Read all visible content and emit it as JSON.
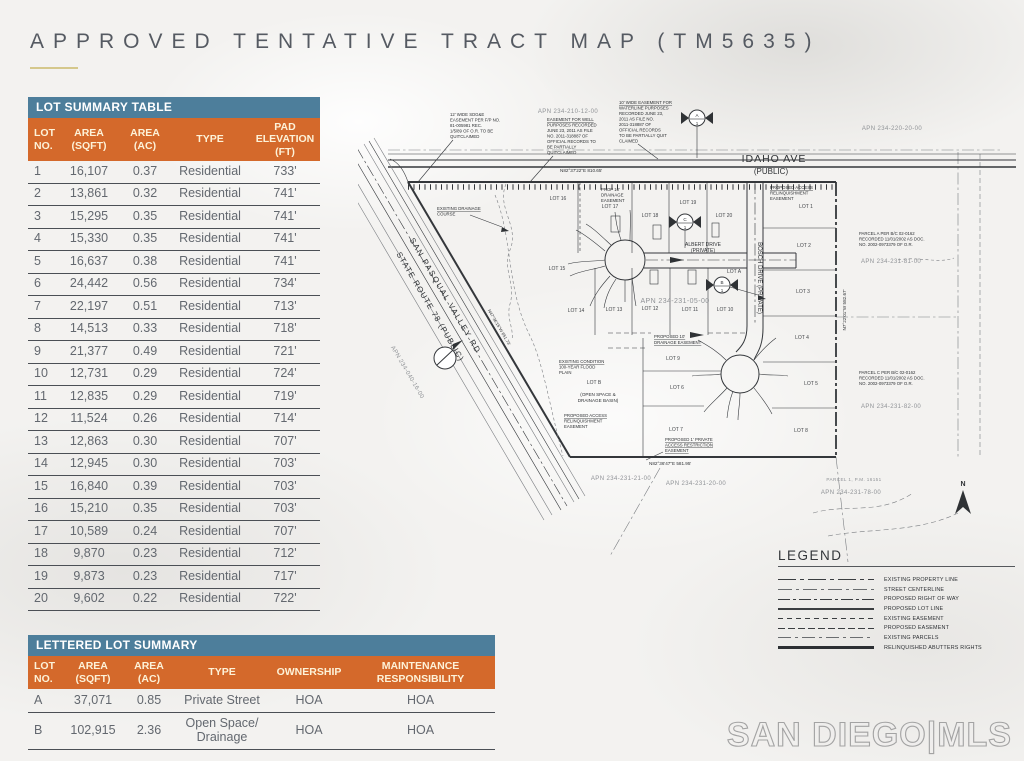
{
  "page_title": "APPROVED TENTATIVE TRACT MAP (TM5635)",
  "lot_summary": {
    "title": "LOT SUMMARY TABLE",
    "columns": [
      "LOT NO.",
      "AREA (SQFT)",
      "AREA (AC)",
      "TYPE",
      "PAD ELEVATION (FT)"
    ],
    "rows": [
      [
        "1",
        "16,107",
        "0.37",
        "Residential",
        "733'"
      ],
      [
        "2",
        "13,861",
        "0.32",
        "Residential",
        "741'"
      ],
      [
        "3",
        "15,295",
        "0.35",
        "Residential",
        "741'"
      ],
      [
        "4",
        "15,330",
        "0.35",
        "Residential",
        "741'"
      ],
      [
        "5",
        "16,637",
        "0.38",
        "Residential",
        "741'"
      ],
      [
        "6",
        "24,442",
        "0.56",
        "Residential",
        "734'"
      ],
      [
        "7",
        "22,197",
        "0.51",
        "Residential",
        "713'"
      ],
      [
        "8",
        "14,513",
        "0.33",
        "Residential",
        "718'"
      ],
      [
        "9",
        "21,377",
        "0.49",
        "Residential",
        "721'"
      ],
      [
        "10",
        "12,731",
        "0.29",
        "Residential",
        "724'"
      ],
      [
        "11",
        "12,835",
        "0.29",
        "Residential",
        "719'"
      ],
      [
        "12",
        "11,524",
        "0.26",
        "Residential",
        "714'"
      ],
      [
        "13",
        "12,863",
        "0.30",
        "Residential",
        "707'"
      ],
      [
        "14",
        "12,945",
        "0.30",
        "Residential",
        "703'"
      ],
      [
        "15",
        "16,840",
        "0.39",
        "Residential",
        "703'"
      ],
      [
        "16",
        "15,210",
        "0.35",
        "Residential",
        "703'"
      ],
      [
        "17",
        "10,589",
        "0.24",
        "Residential",
        "707'"
      ],
      [
        "18",
        "9,870",
        "0.23",
        "Residential",
        "712'"
      ],
      [
        "19",
        "9,873",
        "0.23",
        "Residential",
        "717'"
      ],
      [
        "20",
        "9,602",
        "0.22",
        "Residential",
        "722'"
      ]
    ]
  },
  "lettered_summary": {
    "title": "LETTERED LOT SUMMARY",
    "columns": [
      "LOT NO.",
      "AREA (SQFT)",
      "AREA (AC)",
      "TYPE",
      "OWNERSHIP",
      "MAINTENANCE RESPONSIBILITY"
    ],
    "rows": [
      [
        "A",
        "37,071",
        "0.85",
        "Private Street",
        "HOA",
        "HOA"
      ],
      [
        "B",
        "102,915",
        "2.36",
        "Open Space/ Drainage",
        "HOA",
        "HOA"
      ]
    ]
  },
  "map": {
    "streets": {
      "idaho": [
        "IDAHO AVE",
        "(PUBLIC)"
      ],
      "san_pasqual": [
        "SAN PASQUAL VALLEY RD",
        "STATE ROUTE 78 (PUBLIC)"
      ],
      "albert": [
        "ALBERT DRIVE",
        "(PRIVATE)"
      ],
      "bosch": "BOSCH DRIVE (PRIVATE)"
    },
    "bearings": {
      "top": "N82°37'22\"E   810.65'",
      "bottom": "N82°36'47\"E   581.95'",
      "west": "N47°36'15\"W   651.73'",
      "east": "N7°22'01\"W   582.67'"
    },
    "apns": {
      "top_center": "APN 234-210-12-00",
      "top_right": "APN 234-220-20-00",
      "center": "APN 234-231-05-00",
      "parcel_a": "APN 234-231-81-00",
      "parcel_c": "APN 234-231-82-00",
      "bottom_left": "APN 234-231-21-00",
      "bottom_center": "APN 234-231-20-00",
      "bottom_right": "APN 234-231-78-00",
      "west_road": "APN 234-040-16-00"
    },
    "lots": [
      "LOT 1",
      "LOT 2",
      "LOT 3",
      "LOT 4",
      "LOT 5",
      "LOT 6",
      "LOT 7",
      "LOT 8",
      "LOT 9",
      "LOT 10",
      "LOT 11",
      "LOT 12",
      "LOT 13",
      "LOT 14",
      "LOT 15",
      "LOT 16",
      "LOT 17",
      "LOT 18",
      "LOT 19",
      "LOT 20",
      "LOT A",
      "LOT B"
    ],
    "notes": {
      "sdge": [
        "12' WIDE SDG&E",
        "EASEMENT PER F/P NO.",
        "81-005981 REC.",
        "1/5/89 OF O.R. TO BE",
        "QUITCLAIMED"
      ],
      "well": [
        "EASEMENT FOR WELL",
        "PURPOSES RECORDED",
        "JUNE 23, 2011 AS FILE",
        "NO. 2011-318887 OF",
        "OFFICIAL RECORDS TO",
        "BE PARTIALLY",
        "QUITCLAIMED"
      ],
      "waterline": [
        "10' WIDE EASEMENT FOR",
        "WATERLINE PURPOSES",
        "RECORDED JUNE 23,",
        "2011 AS FILE NO.",
        "2011-318887 OF",
        "OFFICIAL RECORDS",
        "TO BE PARTIALLY QUIT",
        "CLAIMED"
      ],
      "drainage_course": [
        "EXISTING DRAINAGE",
        "COURSE"
      ],
      "prop_drain": [
        "PROP 10'",
        "DRAINAGE",
        "EASEMENT"
      ],
      "access_relinq_ne": [
        "PROPOSED ACCESS",
        "RELINQUISHMENT",
        "EASEMENT"
      ],
      "flood": [
        "EXISTING CONDITION",
        "100-YEAR FLOOD",
        "PLAIN"
      ],
      "open_space": [
        "(OPEN SPACE &",
        "DRAINAGE BASIN)"
      ],
      "access_relinq_w": [
        "PROPOSED ACCESS",
        "RELINQUISHMENT",
        "EASEMENT"
      ],
      "drain10": [
        "PROPOSED 10'",
        "DRAINAGE EASEMENT"
      ],
      "access_restrict": [
        "PROPOSED 1' PRIVATE",
        "ACCESS RESTRICTION",
        "EASEMENT"
      ],
      "parcel_a": [
        "PARCEL A PER B/C 02-0162",
        "RECORDED 11/01/2002 AS DOC.",
        "NO. 2002-0973379 OF O.R."
      ],
      "parcel_c": [
        "PARCEL C PER B/C 02-0162",
        "RECORDED 11/01/2002 AS DOC.",
        "NO. 2002-0973379 OF O.R."
      ],
      "parcel_1": "PARCEL 1, P.M. 16151"
    },
    "markers": {
      "a": "A",
      "b": "B",
      "c": "C",
      "sub": "1"
    },
    "north": "N"
  },
  "legend": {
    "title": "LEGEND",
    "items": [
      "EXISTING PROPERTY LINE",
      "STREET CENTERLINE",
      "PROPOSED RIGHT OF WAY",
      "PROPOSED LOT LINE",
      "EXISTING EASEMENT",
      "PROPOSED EASEMENT",
      "EXISTING PARCELS",
      "RELINQUISHED ABUTTERS RIGHTS"
    ]
  },
  "watermark": "SAN DIEGO|MLS"
}
